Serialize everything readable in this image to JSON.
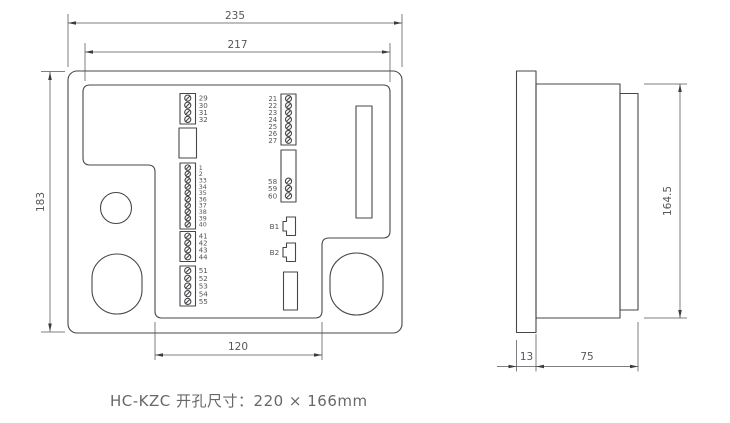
{
  "caption": "HC-KZC 开孔尺寸：220 × 166mm",
  "dims": {
    "front_width": "235",
    "front_inner_width": "217",
    "front_height": "183",
    "front_bottom_width": "120",
    "side_height": "164.5",
    "bezel_depth": "13",
    "body_depth": "75"
  },
  "terminal_groups": {
    "left": [
      {
        "id": "terminal-block-29-32",
        "labels": [
          "29",
          "30",
          "31",
          "32"
        ]
      },
      {
        "id": "blank-module-left",
        "labels": []
      },
      {
        "id": "terminal-block-1-40",
        "labels": [
          "1",
          "2",
          "33",
          "34",
          "35",
          "36",
          "37",
          "38",
          "39",
          "40"
        ]
      },
      {
        "id": "terminal-block-41-44",
        "labels": [
          "41",
          "42",
          "43",
          "44"
        ]
      },
      {
        "id": "terminal-block-51-55",
        "labels": [
          "51",
          "52",
          "53",
          "54",
          "55"
        ]
      }
    ],
    "right": [
      {
        "id": "terminal-block-21-27",
        "labels": [
          "21",
          "22",
          "23",
          "24",
          "25",
          "26",
          "27"
        ]
      },
      {
        "id": "terminal-block-58-60",
        "labels": [
          "58",
          "59",
          "60"
        ]
      },
      {
        "id": "connector-b1",
        "labels": [
          "B1"
        ]
      },
      {
        "id": "connector-b2",
        "labels": [
          "B2"
        ]
      },
      {
        "id": "blank-module-right",
        "labels": []
      }
    ]
  },
  "colors": {
    "line": "#47474a",
    "dimension": "#55555a",
    "text": "#57575b",
    "background": "#ffffff"
  }
}
